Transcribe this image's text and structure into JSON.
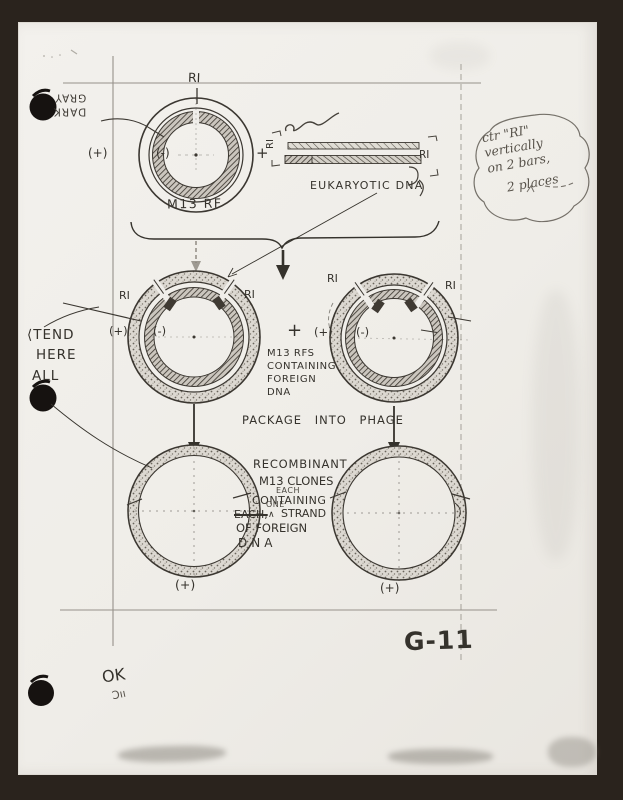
{
  "notes": {
    "dark_gray": {
      "line1": "DARK",
      "line2": "GRAY"
    },
    "bubble": {
      "line1": "ctr \"RI\"",
      "line2": "vertically",
      "line3": "on 2 bars,",
      "line4": "2 places"
    },
    "extend": {
      "line1": "⟨TEND",
      "line2": "HERE",
      "line3": "ALL"
    },
    "ok": "OK",
    "initials": "Ɔıı"
  },
  "top_plasmid": {
    "ri": "RI",
    "plus": "(+)",
    "minus": "(-)",
    "name": "M13 RF"
  },
  "eukaryotic": {
    "plus": "+",
    "ri_left": "RI",
    "ri_right": "RI",
    "label": "EUKARYOTIC DNA"
  },
  "middle": {
    "left": {
      "ri_left": "RI",
      "ri_right": "RI",
      "plus": "(+)",
      "minus": "(-)"
    },
    "plus_sign": "+",
    "right": {
      "ri_left": "RI",
      "ri_right": "RI",
      "plus": "(+)",
      "minus": "(-)"
    },
    "caption": {
      "line1": "M13 RFS",
      "line2": "CONTAINING",
      "line3": "FOREIGN",
      "line4": "DNA"
    }
  },
  "package_label": "PACKAGE INTO PHAGE",
  "bottom": {
    "caption": {
      "line1": "RECOMBINANT",
      "line2": "M13 CLONES",
      "inserted_each": "EACH",
      "line3": "CONTAINING",
      "struck_word": "EACH,",
      "caret": "∧",
      "inserted_one": "ONE",
      "line4_rest": "STRAND",
      "line5": "OF FOREIGN",
      "line6": "DNA"
    },
    "left_plus": "(+)",
    "right_plus": "(+)"
  },
  "figure_number": "G-11"
}
